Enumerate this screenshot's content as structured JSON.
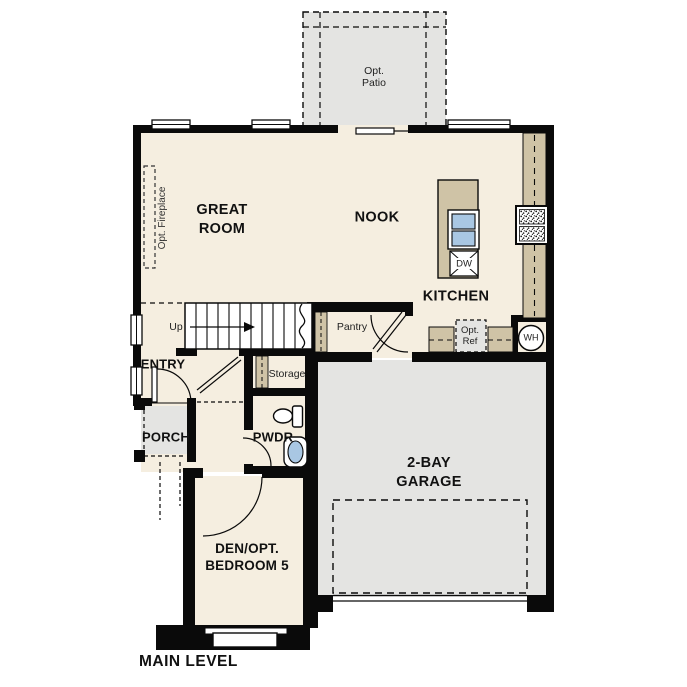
{
  "caption": {
    "main_level": "MAIN LEVEL"
  },
  "rooms": {
    "great_room_line1": "GREAT",
    "great_room_line2": "ROOM",
    "nook": "NOOK",
    "kitchen": "KITCHEN",
    "entry": "ENTRY",
    "porch": "PORCH",
    "pwdr": "PWDR",
    "den_line1": "DEN/OPT.",
    "den_line2": "BEDROOM 5",
    "garage_line1": "2-BAY",
    "garage_line2": "GARAGE"
  },
  "features": {
    "up": "Up",
    "pantry": "Pantry",
    "storage": "Storage",
    "opt_fireplace": "Opt. Fireplace",
    "opt_patio_line1": "Opt.",
    "opt_patio_line2": "Patio",
    "opt_ref_line1": "Opt.",
    "opt_ref_line2": "Ref",
    "dishwasher": "DW",
    "water_heater": "WH"
  },
  "colors": {
    "floor": "#f5eee0",
    "exterior_concrete": "#e4e4e2",
    "counter_tan": "#cfc3a6",
    "fixture_blue": "#a9c7e3",
    "wall": "#0a0a0a"
  }
}
